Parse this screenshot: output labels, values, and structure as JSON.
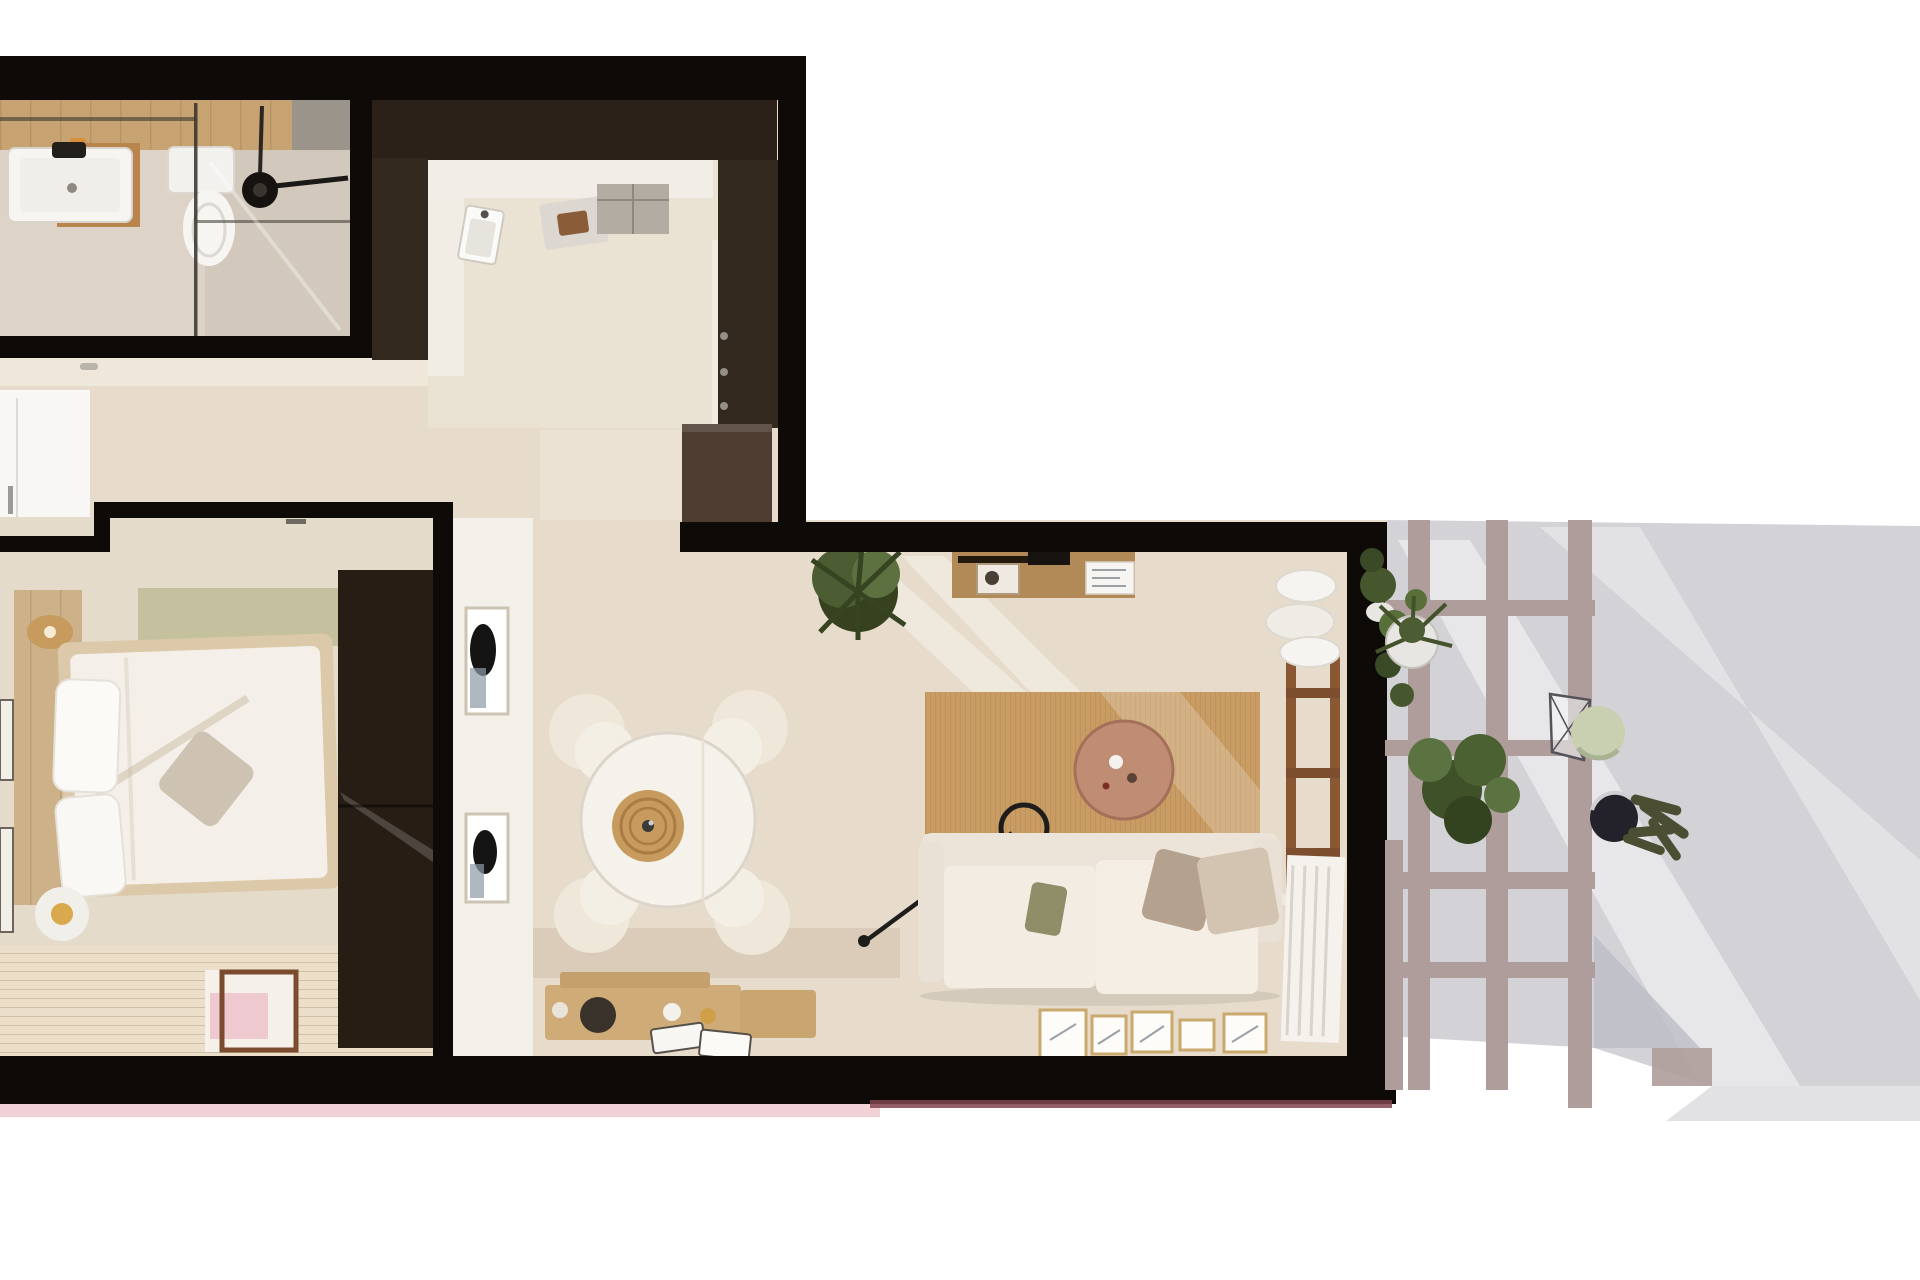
{
  "scene": {
    "kind": "apartment-floorplan-3d-render",
    "view": "top-down",
    "rooms": [
      {
        "id": "bathroom",
        "items": [
          "vanity-sink",
          "mirror-rail",
          "toilet",
          "walk-in-shower",
          "glass-partition",
          "shower-head"
        ]
      },
      {
        "id": "kitchen",
        "items": [
          "tall-cabinet-column",
          "l-shaped-counter",
          "sink",
          "cooktop",
          "appliance-block",
          "island-cabinet"
        ]
      },
      {
        "id": "entry-hall",
        "items": [
          "white-door",
          "console-ledge"
        ]
      },
      {
        "id": "bedroom",
        "items": [
          "double-bed",
          "headboard-panel",
          "rattan-wall-lamp",
          "sage-runner",
          "wardrobe",
          "bedside-lamp",
          "plank-floor",
          "pink-check-rug",
          "wall-frames"
        ]
      },
      {
        "id": "dining-area",
        "items": [
          "round-table",
          "rattan-pendant-lamp",
          "four-chairs",
          "two-wall-frames",
          "wood-crates-decor"
        ]
      },
      {
        "id": "living-room",
        "items": [
          "wood-console-desk",
          "indoor-plant",
          "jute-rug",
          "round-coffee-table",
          "arc-floor-lamp",
          "sofa-with-cushions",
          "floor-art-frames",
          "ladder-shelf-with-blankets"
        ]
      },
      {
        "id": "terrace",
        "items": [
          "pergola-trellis",
          "potted-plant",
          "leafy-plant",
          "wire-chair",
          "stone-ball-plant",
          "cactus-pot",
          "hanging-foliage",
          "gray-decking"
        ]
      }
    ]
  },
  "palette": {
    "wall": "#0d0a07",
    "wall_brown": "#2c2119",
    "column_brown": "#32281e",
    "island_brown": "#4e3d30",
    "floor_base": "#e7dccb",
    "floor_kitchen": "#eae2d3",
    "floor_bathroom": "#ddd3c6",
    "floor_shower": "#d2c8bb",
    "wood_band": "#c7a372",
    "vanity_wood": "#b9854c",
    "white_face": "#f3f0ea",
    "counter_white": "#f2eee7",
    "appliance_gray": "#b3aca3",
    "door_white": "#f8f7f5",
    "bed_frame": "#dcc9a9",
    "duvet": "#f4f0e9",
    "headboard": "#cdb289",
    "sage": "#c5c19f",
    "wardrobe": "#281d15",
    "slat_floor": "#ecdfca",
    "rug_pink": "#eec9cf",
    "table_white": "#f5f2ec",
    "chair_cream": "#efe8da",
    "pendant_rattan": "#c79a5d",
    "desk_wood": "#b18a58",
    "jute": "#c89c63",
    "coffee_table": "#bf8d74",
    "sofa": "#ece4d8",
    "cushion_olive": "#8f8e69",
    "cushion_taupe": "#b4a28e",
    "cushion_cream": "#d2c4b0",
    "ladder_wood": "#8a5733",
    "terrace_gray": "#d3d3d7",
    "terrace_step": "#e2e2e5",
    "pergola": "#ae9d9b",
    "plant_dark": "#37411f",
    "plant_mid": "#4c5c33",
    "plant_light": "#5d7040",
    "plant_ball": "#c9d0b2",
    "pink_strip": "#f1d0d6",
    "maroon_strip": "#82454f",
    "black_detail": "#1f1d1b"
  }
}
